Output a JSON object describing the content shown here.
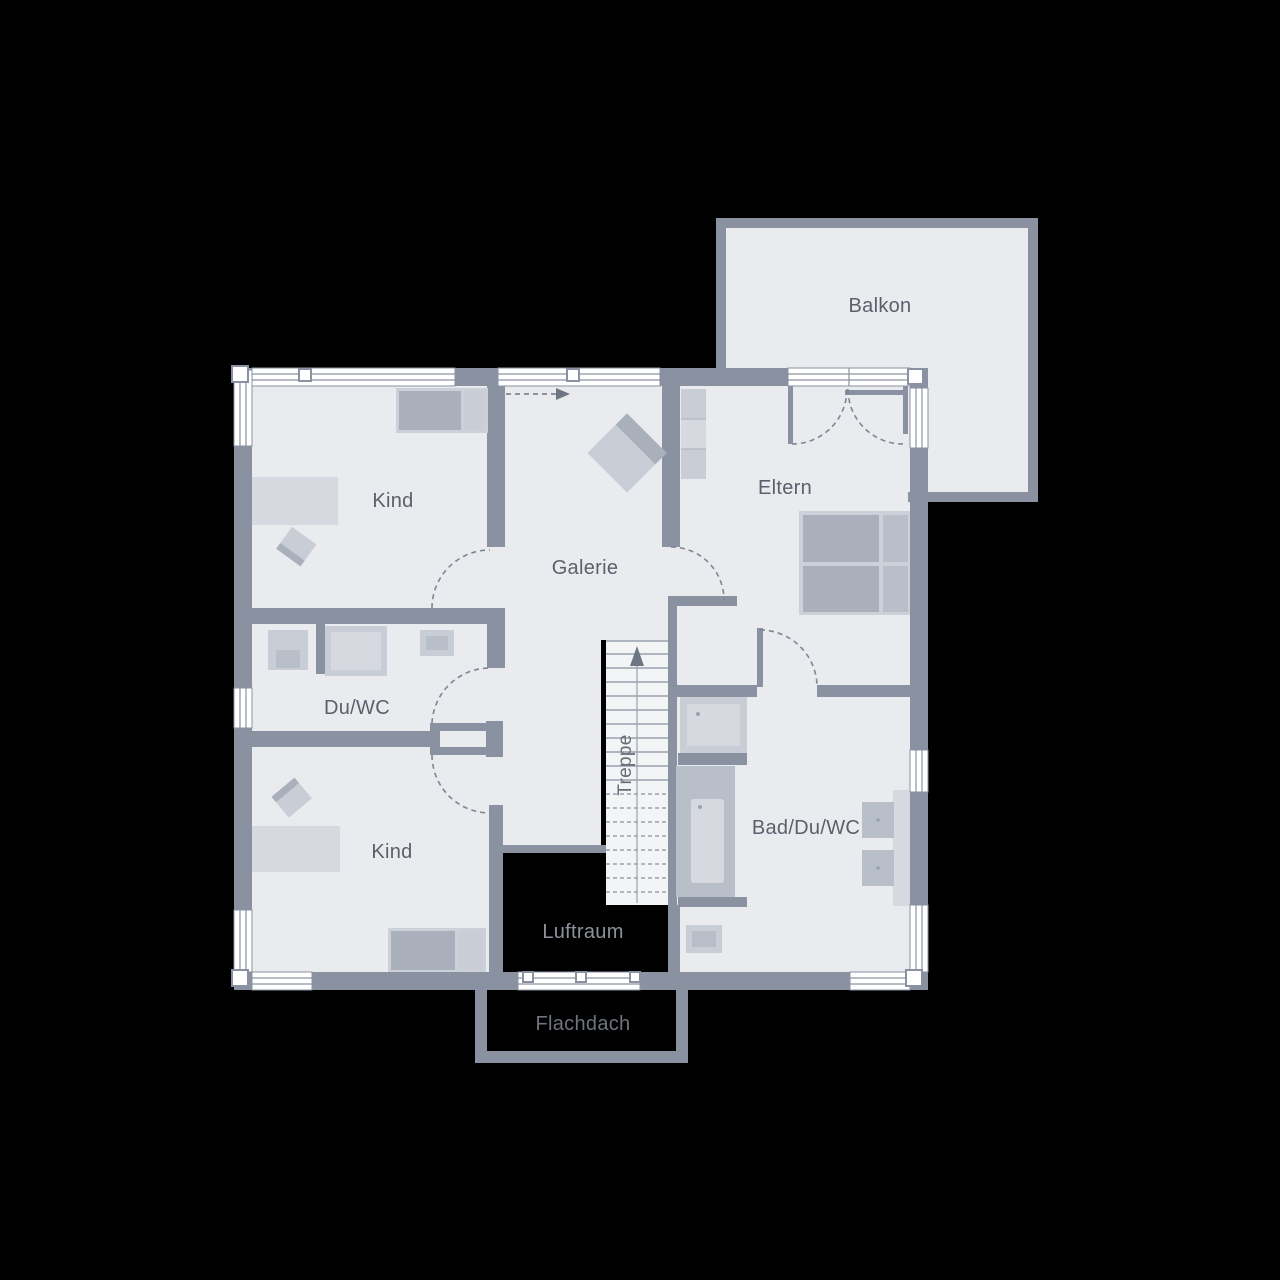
{
  "plan": {
    "rooms": {
      "balkon": "Balkon",
      "kind_top": "Kind",
      "eltern": "Eltern",
      "galerie": "Galerie",
      "du_wc": "Du/WC",
      "kind_bottom": "Kind",
      "bad_du_wc": "Bad/Du/WC",
      "treppe": "Treppe",
      "luftraum": "Luftraum",
      "flachdach": "Flachdach"
    },
    "colors": {
      "background": "#000000",
      "wall": "#8a92a1",
      "floor": "#e9ebef",
      "stairs_floor": "#f3f4f6",
      "furniture_light": "#d6d9df",
      "furniture_mid": "#c9cdd5",
      "furniture_dark": "#a9b0bb",
      "label": "#5a616c",
      "label_on_void": "#8d929a",
      "label_roof": "#6e737c"
    }
  }
}
